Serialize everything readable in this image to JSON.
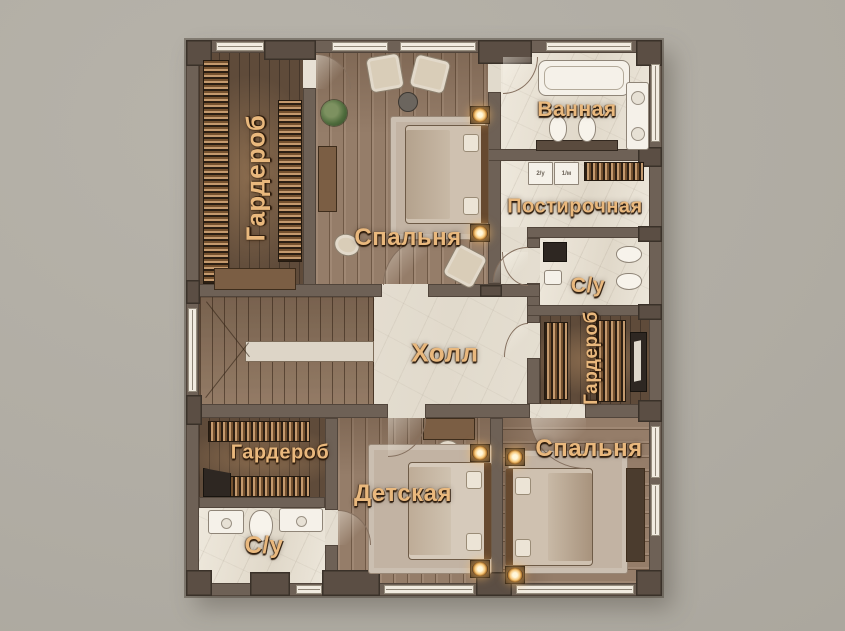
{
  "colors": {
    "background": "#b2aea5",
    "wall": "#6e6156",
    "wall-dark": "#5b4e44",
    "label": "#e9b87d",
    "tile": "#e9e2d6",
    "wood": "#957d69",
    "wood-dark": "#5f4b3a"
  },
  "rooms": {
    "wardrobe_top_left": {
      "label": "Гардероб",
      "orientation": "vertical"
    },
    "bedroom_top": {
      "label": "Спальня",
      "orientation": "horizontal"
    },
    "bathroom": {
      "label": "Ванная",
      "orientation": "horizontal"
    },
    "laundry": {
      "label": "Постирочная",
      "orientation": "horizontal"
    },
    "wc_right": {
      "label": "С/у",
      "orientation": "horizontal"
    },
    "wardrobe_right": {
      "label": "Гардероб",
      "orientation": "vertical"
    },
    "hall": {
      "label": "Холл",
      "orientation": "horizontal"
    },
    "wardrobe_bottom_left": {
      "label": "Гардероб",
      "orientation": "horizontal"
    },
    "wc_bottom_left": {
      "label": "С/у",
      "orientation": "horizontal"
    },
    "kids_room": {
      "label": "Детская",
      "orientation": "horizontal"
    },
    "bedroom_bottom_right": {
      "label": "Спальня",
      "orientation": "horizontal"
    }
  },
  "appliances": {
    "washer_badges": [
      "2/у",
      "1/м"
    ]
  }
}
